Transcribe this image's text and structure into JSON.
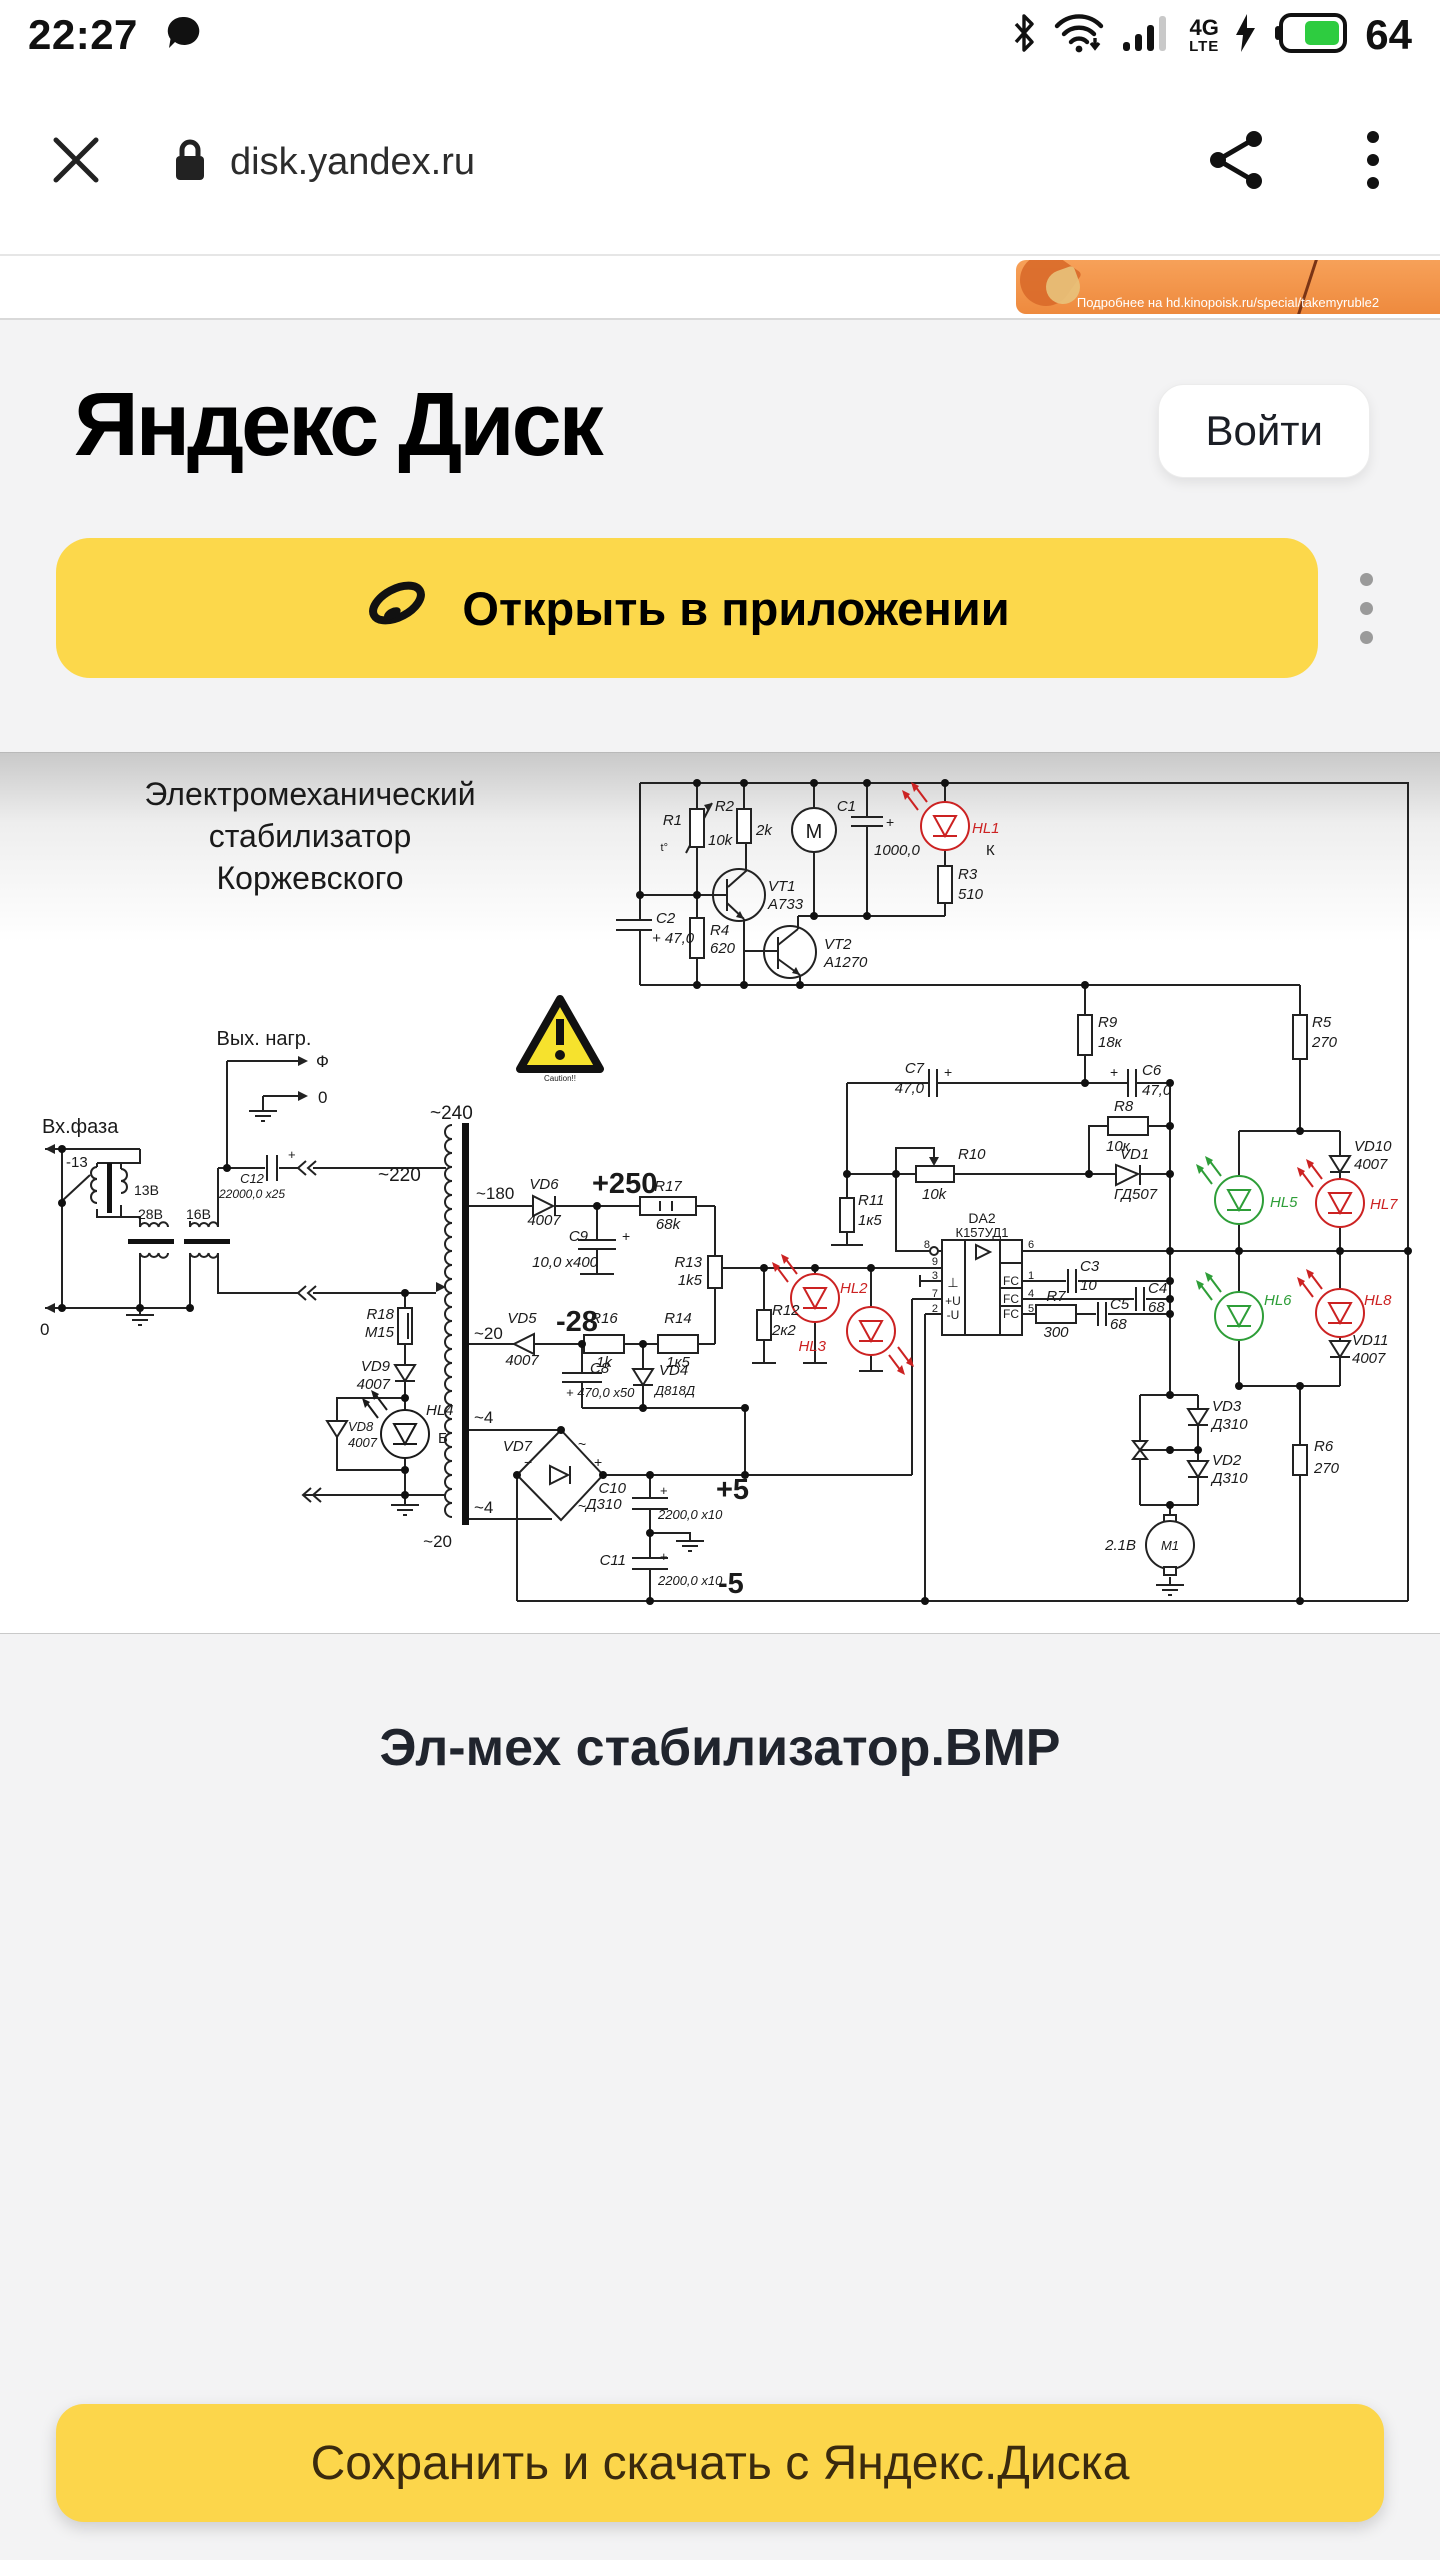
{
  "status_bar": {
    "time": "22:27",
    "network_top": "4G",
    "network_bottom": "LTE",
    "battery": "64",
    "battery_color": "#2ecc40"
  },
  "browser": {
    "url": "disk.yandex.ru"
  },
  "promo_banner": {
    "text": "Подробнее на hd.kinopoisk.ru/special/takemyruble2"
  },
  "header": {
    "title": "Яндекс Диск",
    "login": "Войти"
  },
  "open_app": {
    "label": "Открыть в приложении"
  },
  "viewer": {
    "file_name": "Эл-мех стабилизатор.BMP",
    "save_button": "Сохранить и скачать с Яндекс.Диска"
  },
  "colors": {
    "accent_yellow": "#fcd84b",
    "led_red": "#c22",
    "led_green": "#2e9e38"
  },
  "schematic": {
    "texts": [
      {
        "t": "Электромеханический",
        "x": 310,
        "y": 52,
        "s": 32,
        "a": "middle"
      },
      {
        "t": "стабилизатор",
        "x": 310,
        "y": 94,
        "s": 32,
        "a": "middle"
      },
      {
        "t": "Коржевского",
        "x": 310,
        "y": 136,
        "s": 32,
        "a": "middle"
      },
      {
        "t": "R1",
        "x": 682,
        "y": 72,
        "a": "end",
        "i": 1
      },
      {
        "t": "10k",
        "x": 708,
        "y": 92,
        "i": 1
      },
      {
        "t": "t°",
        "x": 668,
        "y": 98,
        "s": 11,
        "a": "end"
      },
      {
        "t": "R2",
        "x": 734,
        "y": 58,
        "a": "end",
        "i": 1
      },
      {
        "t": "2k",
        "x": 756,
        "y": 82,
        "i": 1
      },
      {
        "t": "M",
        "x": 814,
        "y": 85,
        "s": 20,
        "a": "middle"
      },
      {
        "t": "C1",
        "x": 856,
        "y": 58,
        "a": "end",
        "i": 1
      },
      {
        "t": "+",
        "x": 886,
        "y": 74,
        "s": 14
      },
      {
        "t": "1000,0",
        "x": 874,
        "y": 102,
        "i": 1
      },
      {
        "t": "HL1",
        "x": 972,
        "y": 80,
        "c": "#c22",
        "i": 1
      },
      {
        "t": "К",
        "x": 986,
        "y": 102
      },
      {
        "t": "R3",
        "x": 958,
        "y": 126,
        "i": 1
      },
      {
        "t": "510",
        "x": 958,
        "y": 146,
        "i": 1
      },
      {
        "t": "VT1",
        "x": 768,
        "y": 138,
        "i": 1
      },
      {
        "t": "A733",
        "x": 768,
        "y": 156,
        "i": 1
      },
      {
        "t": "VT2",
        "x": 824,
        "y": 196,
        "i": 1
      },
      {
        "t": "A1270",
        "x": 824,
        "y": 214,
        "i": 1
      },
      {
        "t": "C2",
        "x": 656,
        "y": 170,
        "i": 1
      },
      {
        "t": "+ 47,0",
        "x": 652,
        "y": 190,
        "i": 1
      },
      {
        "t": "R4",
        "x": 710,
        "y": 182,
        "i": 1
      },
      {
        "t": "620",
        "x": 710,
        "y": 200,
        "i": 1
      },
      {
        "t": "R9",
        "x": 1098,
        "y": 274,
        "i": 1
      },
      {
        "t": "18к",
        "x": 1098,
        "y": 294,
        "i": 1
      },
      {
        "t": "R5",
        "x": 1312,
        "y": 274,
        "i": 1
      },
      {
        "t": "270",
        "x": 1312,
        "y": 294,
        "i": 1
      },
      {
        "t": "C7",
        "x": 924,
        "y": 320,
        "a": "end",
        "i": 1
      },
      {
        "t": "47,0",
        "x": 924,
        "y": 340,
        "a": "end",
        "i": 1
      },
      {
        "t": "+",
        "x": 944,
        "y": 324,
        "s": 14
      },
      {
        "t": "+",
        "x": 1110,
        "y": 324,
        "s": 14
      },
      {
        "t": "C6",
        "x": 1142,
        "y": 322,
        "i": 1
      },
      {
        "t": "47,0",
        "x": 1142,
        "y": 342,
        "i": 1
      },
      {
        "t": "R8",
        "x": 1114,
        "y": 358,
        "i": 1
      },
      {
        "t": "10к",
        "x": 1106,
        "y": 398,
        "i": 1
      },
      {
        "t": "VD1",
        "x": 1120,
        "y": 406,
        "i": 1
      },
      {
        "t": "ГД507",
        "x": 1114,
        "y": 446,
        "i": 1
      },
      {
        "t": "R10",
        "x": 958,
        "y": 406,
        "i": 1
      },
      {
        "t": "10k",
        "x": 922,
        "y": 446,
        "i": 1
      },
      {
        "t": "R11",
        "x": 858,
        "y": 452,
        "i": 1
      },
      {
        "t": "1к5",
        "x": 858,
        "y": 472,
        "i": 1
      },
      {
        "t": "HL5",
        "x": 1270,
        "y": 454,
        "c": "#2e9e38",
        "i": 1
      },
      {
        "t": "VD10",
        "x": 1354,
        "y": 398,
        "i": 1
      },
      {
        "t": "4007",
        "x": 1354,
        "y": 416,
        "i": 1
      },
      {
        "t": "HL7",
        "x": 1370,
        "y": 456,
        "c": "#c22",
        "i": 1
      },
      {
        "t": "HL6",
        "x": 1264,
        "y": 552,
        "c": "#2e9e38",
        "i": 1
      },
      {
        "t": "HL8",
        "x": 1364,
        "y": 552,
        "c": "#c22",
        "i": 1
      },
      {
        "t": "VD11",
        "x": 1352,
        "y": 592,
        "i": 1
      },
      {
        "t": "4007",
        "x": 1352,
        "y": 610,
        "i": 1
      },
      {
        "t": "~180",
        "x": 476,
        "y": 446,
        "s": 17
      },
      {
        "t": "VD6",
        "x": 544,
        "y": 436,
        "a": "middle",
        "i": 1
      },
      {
        "t": "4007",
        "x": 544,
        "y": 472,
        "a": "middle",
        "i": 1
      },
      {
        "t": "+250",
        "x": 592,
        "y": 440,
        "s": 29,
        "b": 1
      },
      {
        "t": "R17",
        "x": 668,
        "y": 438,
        "a": "middle",
        "i": 1
      },
      {
        "t": "68k",
        "x": 668,
        "y": 476,
        "a": "middle",
        "i": 1
      },
      {
        "t": "C9",
        "x": 588,
        "y": 488,
        "a": "end",
        "i": 1
      },
      {
        "t": "+",
        "x": 622,
        "y": 488,
        "s": 14
      },
      {
        "t": "10,0 x400",
        "x": 598,
        "y": 514,
        "a": "end",
        "i": 1
      },
      {
        "t": "R13",
        "x": 702,
        "y": 514,
        "a": "end",
        "i": 1
      },
      {
        "t": "1k5",
        "x": 702,
        "y": 532,
        "a": "end",
        "i": 1
      },
      {
        "t": "~20",
        "x": 474,
        "y": 586,
        "s": 17
      },
      {
        "t": "VD5",
        "x": 522,
        "y": 570,
        "a": "middle",
        "i": 1
      },
      {
        "t": "4007",
        "x": 522,
        "y": 612,
        "a": "middle",
        "i": 1
      },
      {
        "t": "-28",
        "x": 556,
        "y": 578,
        "s": 29,
        "b": 1
      },
      {
        "t": "R16",
        "x": 604,
        "y": 570,
        "a": "middle",
        "i": 1
      },
      {
        "t": "1k",
        "x": 604,
        "y": 614,
        "a": "middle",
        "i": 1
      },
      {
        "t": "R14",
        "x": 678,
        "y": 570,
        "a": "middle",
        "i": 1
      },
      {
        "t": "1к5",
        "x": 678,
        "y": 614,
        "a": "middle",
        "i": 1
      },
      {
        "t": "C8",
        "x": 590,
        "y": 620,
        "i": 1
      },
      {
        "t": "+ 470,0 x50",
        "x": 566,
        "y": 644,
        "s": 13,
        "i": 1
      },
      {
        "t": "VD4",
        "x": 659,
        "y": 622,
        "i": 1
      },
      {
        "t": "Д818Д",
        "x": 655,
        "y": 642,
        "s": 13,
        "i": 1
      },
      {
        "t": "R12",
        "x": 772,
        "y": 562,
        "i": 1
      },
      {
        "t": "2к2",
        "x": 772,
        "y": 582,
        "i": 1
      },
      {
        "t": "HL2",
        "x": 840,
        "y": 540,
        "c": "#c22",
        "i": 1
      },
      {
        "t": "HL3",
        "x": 826,
        "y": 598,
        "a": "end",
        "c": "#c22",
        "i": 1
      },
      {
        "t": "~4",
        "x": 474,
        "y": 670,
        "s": 17
      },
      {
        "t": "VD7",
        "x": 532,
        "y": 698,
        "a": "end",
        "i": 1
      },
      {
        "t": "~",
        "x": 578,
        "y": 696,
        "s": 14
      },
      {
        "t": "+",
        "x": 594,
        "y": 714,
        "s": 14
      },
      {
        "t": "−",
        "x": 524,
        "y": 714,
        "s": 14
      },
      {
        "t": "~",
        "x": 578,
        "y": 758,
        "s": 14
      },
      {
        "t": "Д310",
        "x": 586,
        "y": 756,
        "i": 1
      },
      {
        "t": "~4",
        "x": 474,
        "y": 760,
        "s": 17
      },
      {
        "t": "~20",
        "x": 452,
        "y": 794,
        "s": 17,
        "a": "end"
      },
      {
        "t": "C10",
        "x": 626,
        "y": 740,
        "a": "end",
        "i": 1
      },
      {
        "t": "+",
        "x": 660,
        "y": 742,
        "s": 13
      },
      {
        "t": "2200,0 x10",
        "x": 658,
        "y": 766,
        "s": 13,
        "i": 1
      },
      {
        "t": "+5",
        "x": 716,
        "y": 746,
        "s": 29,
        "b": 1
      },
      {
        "t": "C11",
        "x": 626,
        "y": 812,
        "a": "end",
        "i": 1
      },
      {
        "t": "+",
        "x": 660,
        "y": 808,
        "s": 13
      },
      {
        "t": "2200,0 x10",
        "x": 658,
        "y": 832,
        "s": 13,
        "i": 1
      },
      {
        "t": "-5",
        "x": 718,
        "y": 840,
        "s": 29,
        "b": 1
      },
      {
        "t": "DA2",
        "x": 982,
        "y": 470,
        "s": 14,
        "a": "middle"
      },
      {
        "t": "К157УД1",
        "x": 982,
        "y": 484,
        "s": 13,
        "a": "middle"
      },
      {
        "t": "8",
        "x": 930,
        "y": 495,
        "s": 11,
        "a": "end"
      },
      {
        "t": "9",
        "x": 938,
        "y": 512,
        "s": 11,
        "a": "end"
      },
      {
        "t": "3",
        "x": 938,
        "y": 526,
        "s": 11,
        "a": "end"
      },
      {
        "t": "7",
        "x": 938,
        "y": 544,
        "s": 11,
        "a": "end"
      },
      {
        "t": "2",
        "x": 938,
        "y": 559,
        "s": 11,
        "a": "end"
      },
      {
        "t": "6",
        "x": 1028,
        "y": 495,
        "s": 11
      },
      {
        "t": "1",
        "x": 1028,
        "y": 526,
        "s": 11
      },
      {
        "t": "4",
        "x": 1028,
        "y": 544,
        "s": 11
      },
      {
        "t": "5",
        "x": 1028,
        "y": 559,
        "s": 11
      },
      {
        "t": "⊥",
        "x": 953,
        "y": 534,
        "s": 13,
        "a": "middle"
      },
      {
        "t": "+U",
        "x": 953,
        "y": 552,
        "s": 12,
        "a": "middle"
      },
      {
        "t": "-U",
        "x": 953,
        "y": 566,
        "s": 12,
        "a": "middle"
      },
      {
        "t": "FC",
        "x": 1011,
        "y": 532,
        "s": 12,
        "a": "middle"
      },
      {
        "t": "FC",
        "x": 1011,
        "y": 550,
        "s": 12,
        "a": "middle"
      },
      {
        "t": "FC",
        "x": 1011,
        "y": 565,
        "s": 12,
        "a": "middle"
      },
      {
        "t": "C3",
        "x": 1080,
        "y": 518,
        "i": 1
      },
      {
        "t": "10",
        "x": 1080,
        "y": 537,
        "i": 1
      },
      {
        "t": "C4",
        "x": 1148,
        "y": 540,
        "i": 1
      },
      {
        "t": "68",
        "x": 1148,
        "y": 559,
        "i": 1
      },
      {
        "t": "R7",
        "x": 1056,
        "y": 548,
        "a": "middle",
        "i": 1
      },
      {
        "t": "300",
        "x": 1056,
        "y": 584,
        "a": "middle",
        "i": 1
      },
      {
        "t": "C5",
        "x": 1110,
        "y": 556,
        "i": 1
      },
      {
        "t": "68",
        "x": 1110,
        "y": 576,
        "i": 1
      },
      {
        "t": "VD3",
        "x": 1212,
        "y": 658,
        "i": 1
      },
      {
        "t": "Д310",
        "x": 1212,
        "y": 676,
        "i": 1
      },
      {
        "t": "VD2",
        "x": 1212,
        "y": 712,
        "i": 1
      },
      {
        "t": "Д310",
        "x": 1212,
        "y": 730,
        "i": 1
      },
      {
        "t": "R6",
        "x": 1314,
        "y": 698,
        "i": 1
      },
      {
        "t": "270",
        "x": 1314,
        "y": 720,
        "i": 1
      },
      {
        "t": "2.1В",
        "x": 1136,
        "y": 797,
        "a": "end",
        "i": 1
      },
      {
        "t": "M1",
        "x": 1170,
        "y": 797,
        "s": 13,
        "a": "middle",
        "i": 1
      },
      {
        "t": "R18",
        "x": 394,
        "y": 566,
        "a": "end",
        "i": 1
      },
      {
        "t": "M15",
        "x": 394,
        "y": 584,
        "a": "end",
        "i": 1
      },
      {
        "t": "VD9",
        "x": 390,
        "y": 618,
        "a": "end",
        "i": 1
      },
      {
        "t": "4007",
        "x": 390,
        "y": 636,
        "a": "end",
        "i": 1
      },
      {
        "t": "HL4",
        "x": 426,
        "y": 662,
        "i": 1
      },
      {
        "t": "Б",
        "x": 438,
        "y": 690
      },
      {
        "t": "VD8",
        "x": 348,
        "y": 678,
        "s": 13,
        "i": 1
      },
      {
        "t": "4007",
        "x": 348,
        "y": 694,
        "s": 13,
        "i": 1
      },
      {
        "t": "Вых. нагр.",
        "x": 264,
        "y": 292,
        "s": 20,
        "a": "middle"
      },
      {
        "t": "Ф",
        "x": 316,
        "y": 314,
        "s": 17
      },
      {
        "t": "0",
        "x": 318,
        "y": 350,
        "s": 17
      },
      {
        "t": "Вх.фаза",
        "x": 42,
        "y": 380,
        "s": 20
      },
      {
        "t": "-13",
        "x": 66,
        "y": 414,
        "s": 15
      },
      {
        "t": "13В",
        "x": 134,
        "y": 442,
        "s": 14
      },
      {
        "t": "28В",
        "x": 138,
        "y": 466,
        "s": 14
      },
      {
        "t": "16В",
        "x": 186,
        "y": 466,
        "s": 14
      },
      {
        "t": "0",
        "x": 40,
        "y": 582,
        "s": 17
      },
      {
        "t": "C12",
        "x": 252,
        "y": 430,
        "s": 13,
        "a": "middle",
        "i": 1
      },
      {
        "t": "22000,0 x25",
        "x": 252,
        "y": 445,
        "s": 12,
        "a": "middle",
        "i": 1
      },
      {
        "t": "+",
        "x": 288,
        "y": 406,
        "s": 13
      },
      {
        "t": "~220",
        "x": 378,
        "y": 428,
        "s": 19
      },
      {
        "t": "~240",
        "x": 430,
        "y": 366,
        "s": 19
      },
      {
        "t": "Caution!!",
        "x": 560,
        "y": 328,
        "s": 8,
        "a": "middle"
      }
    ]
  }
}
